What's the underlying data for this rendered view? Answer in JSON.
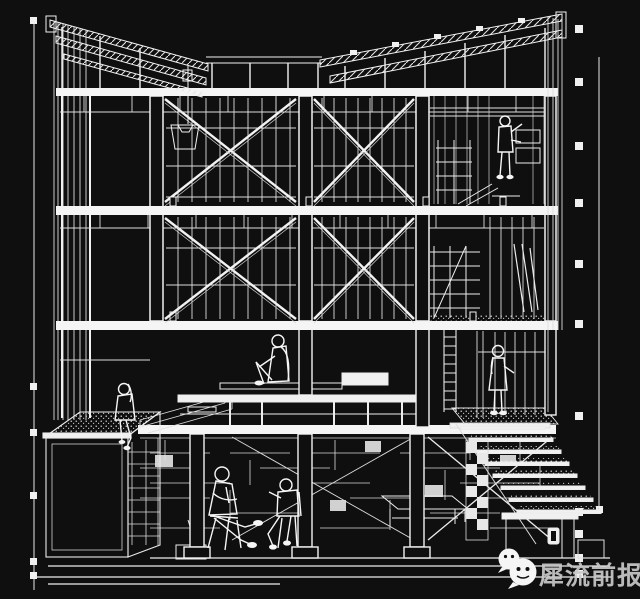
{
  "colors": {
    "background": "#0f0f0f",
    "line": "#f2f2f2",
    "solid": "#f5f5f5",
    "watermark_text": "#c9c9c9",
    "wechat_bubble": "#f5f5f5",
    "wechat_face": "#101010"
  },
  "watermark": {
    "text": "犀流前报",
    "icon": "wechat-icon"
  },
  "drawing": {
    "kind": "architectural-sectional-perspective",
    "figures": [
      {
        "label": "person-climbing-shelves"
      },
      {
        "label": "woman-sitting-on-platform"
      },
      {
        "label": "girl-sitting-on-roof-garden"
      },
      {
        "label": "woman-standing-by-ladder"
      },
      {
        "label": "man-seated-left"
      },
      {
        "label": "man-seated-right"
      }
    ]
  }
}
